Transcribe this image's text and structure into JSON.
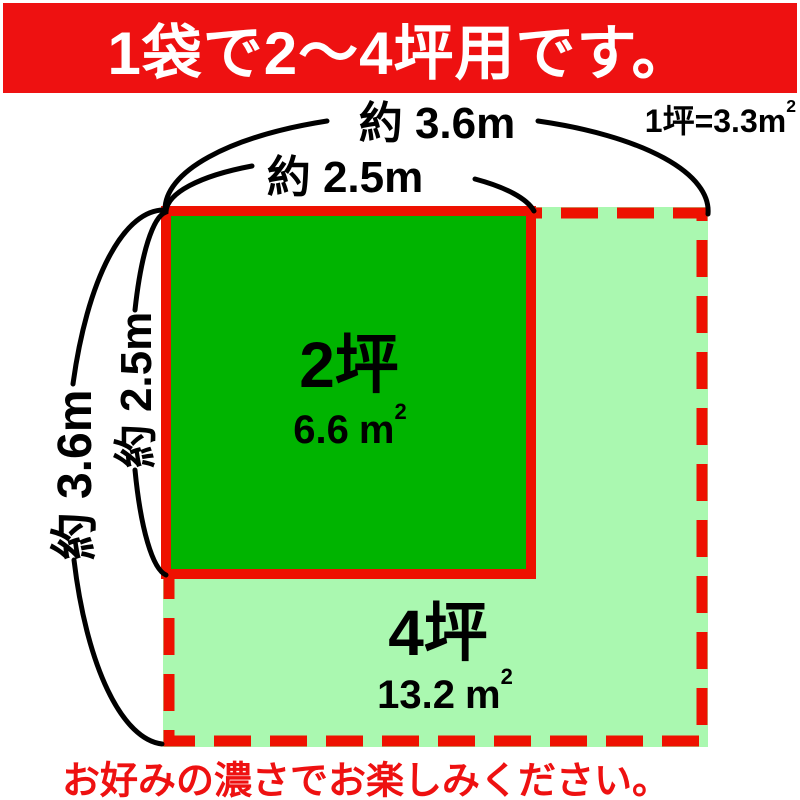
{
  "banner": {
    "text": "1袋で2〜4坪用です。",
    "bg_color": "#ee1111",
    "text_color": "#ffffff"
  },
  "unit_note": {
    "prefix": "1坪=3.3",
    "unit": "m",
    "sup": "2"
  },
  "measurements": {
    "outer_width_label": "約 3.6m",
    "inner_width_label": "約 2.5m",
    "inner_height_label": "約 2.5m",
    "outer_height_label": "約 3.6m"
  },
  "inner_area": {
    "name": "2坪",
    "value": "6.6",
    "unit": "m",
    "sup": "2",
    "fill_color": "#00b400"
  },
  "outer_area": {
    "name": "4坪",
    "value": "13.2",
    "unit": "m",
    "sup": "2",
    "fill_color": "#aaf8b0"
  },
  "footer": {
    "text": "お好みの濃さでお楽しみください。",
    "text_color": "#ee1111"
  },
  "colors": {
    "border_red": "#ee1100",
    "arc_black": "#000000",
    "background": "#ffffff"
  }
}
